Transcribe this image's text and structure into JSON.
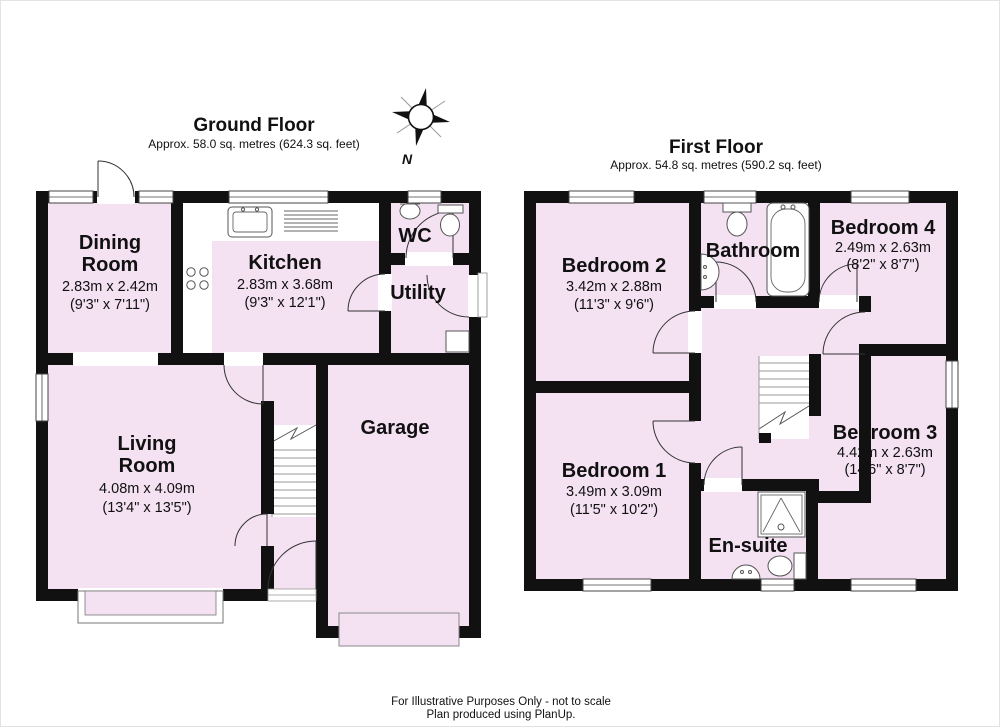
{
  "ground_floor": {
    "title": "Ground Floor",
    "area": "Approx. 58.0 sq. metres (624.3 sq. feet)",
    "rooms": {
      "dining": {
        "name1": "Dining",
        "name2": "Room",
        "metric": "2.83m x 2.42m",
        "imperial": "(9'3\" x 7'11\")"
      },
      "kitchen": {
        "name": "Kitchen",
        "metric": "2.83m x 3.68m",
        "imperial": "(9'3\" x 12'1\")"
      },
      "wc": {
        "name": "WC"
      },
      "utility": {
        "name": "Utility"
      },
      "living": {
        "name1": "Living",
        "name2": "Room",
        "metric": "4.08m x 4.09m",
        "imperial": "(13'4\" x 13'5\")"
      },
      "garage": {
        "name": "Garage"
      }
    }
  },
  "first_floor": {
    "title": "First Floor",
    "area": "Approx. 54.8 sq. metres (590.2 sq. feet)",
    "rooms": {
      "bedroom2": {
        "name": "Bedroom 2",
        "metric": "3.42m x 2.88m",
        "imperial": "(11'3\" x 9'6\")"
      },
      "bathroom": {
        "name": "Bathroom"
      },
      "bedroom4": {
        "name": "Bedroom 4",
        "metric": "2.49m x 2.63m",
        "imperial": "(8'2\" x 8'7\")"
      },
      "bedroom1": {
        "name": "Bedroom 1",
        "metric": "3.49m x 3.09m",
        "imperial": "(11'5\" x 10'2\")"
      },
      "ensuite": {
        "name": "En-suite"
      },
      "bedroom3": {
        "name": "Bedroom 3",
        "metric": "4.42m x 2.63m",
        "imperial": "(14'6\" x 8'7\")"
      }
    }
  },
  "compass": {
    "label": "N"
  },
  "footer": {
    "line1": "For Illustrative Purposes Only - not to scale",
    "line2": "Plan produced using PlanUp."
  },
  "colors": {
    "room_fill": "#f4e2f3",
    "wall": "#111111"
  }
}
